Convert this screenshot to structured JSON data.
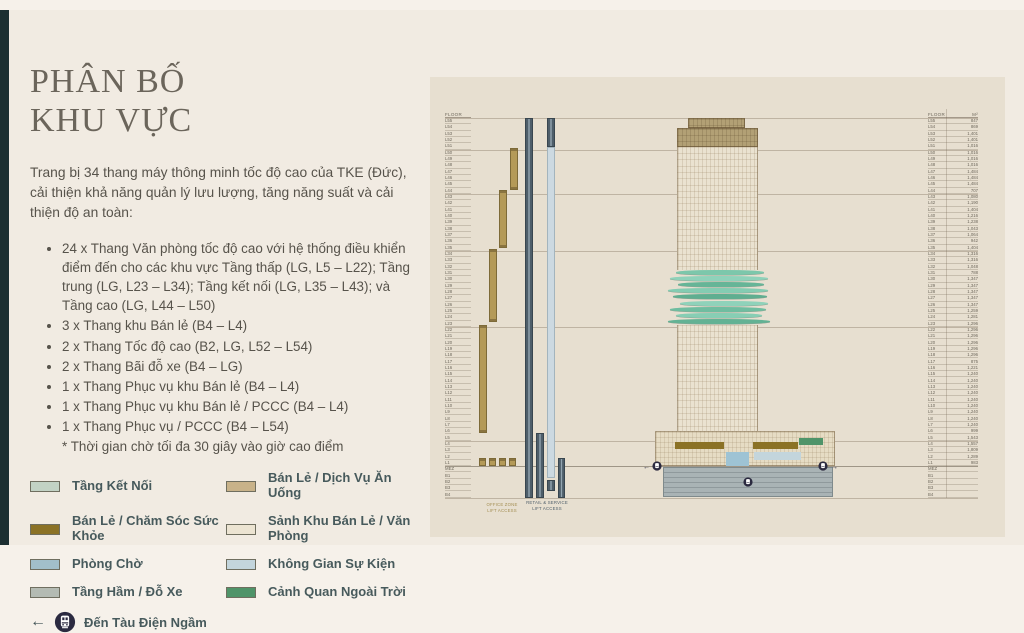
{
  "header": {
    "title_line1": "PHÂN BỐ",
    "title_line2": "KHU VỰC",
    "intro": "Trang bị 34 thang máy thông minh tốc độ cao của TKE (Đức), cải thiện khả năng quản lý lưu lượng, tăng năng suất và cải thiện độ an toàn:",
    "bullets": [
      "24 x Thang Văn phòng tốc độ cao với hệ thống điều khiển điểm đến cho các khu vực Tầng thấp (LG, L5 – L22); Tầng trung (LG, L23 – L34); Tầng kết nối (LG, L35 – L43); và Tầng cao (LG, L44 – L50)",
      "3 x Thang khu Bán lẻ (B4 – L4)",
      "2 x Thang Tốc độ cao (B2, LG, L52 – L54)",
      "2 x Thang Bãi đỗ xe (B4 – LG)",
      "1 x Thang Phục vụ khu Bán lẻ (B4 – L4)",
      "1 x Thang Phục vụ khu Bán lẻ / PCCC (B4 – L4)",
      "1 x Thang Phục vụ / PCCC (B4 – L54)"
    ],
    "footnote": "* Thời gian chờ tối đa 30 giây vào giờ cao điểm"
  },
  "legend": {
    "left": [
      {
        "label": "Tầng Kết Nối",
        "color": "#c2d2c4"
      },
      {
        "label": "Bán Lẻ / Chăm Sóc Sức Khỏe",
        "color": "#8b7226"
      },
      {
        "label": "Phòng Chờ",
        "color": "#a2bfca"
      },
      {
        "label": "Tầng Hầm / Đỗ Xe",
        "color": "#b4bbb3"
      }
    ],
    "right": [
      {
        "label": "Bán Lẻ / Dịch Vụ Ăn Uống",
        "color": "#c8b289"
      },
      {
        "label": "Sảnh Khu Bán Lẻ / Văn Phòng",
        "color": "#ece4d2"
      },
      {
        "label": "Không Gian Sự Kiện",
        "color": "#c3d5dc"
      },
      {
        "label": "Cảnh Quan Ngoài Trời",
        "color": "#4f9469"
      }
    ],
    "metro_arrow": "←",
    "metro_label": "Đến Tàu Điện Ngầm"
  },
  "diagram": {
    "left_header": "FLOOR",
    "right_header_floor": "FLOOR",
    "right_header_area": "M²",
    "shaft_labels": [
      {
        "line1": "OFFICE ZONE",
        "line2": "LIFT ACCESS"
      },
      {
        "line1": "RETAIL & SERVICE",
        "line2": "LIFT ACCESS"
      }
    ],
    "boundaries_below": [
      "L51",
      "L44",
      "L35",
      "L23",
      "L5",
      "B4"
    ],
    "ground_below": "L1",
    "floors": [
      {
        "name": "L55",
        "area": "847"
      },
      {
        "name": "L54",
        "area": "869"
      },
      {
        "name": "L53",
        "area": "1,401"
      },
      {
        "name": "L52",
        "area": "1,401"
      },
      {
        "name": "L51",
        "area": "1,016"
      },
      {
        "name": "L50",
        "area": "1,016"
      },
      {
        "name": "L49",
        "area": "1,016"
      },
      {
        "name": "L48",
        "area": "1,016"
      },
      {
        "name": "L47",
        "area": "1,484"
      },
      {
        "name": "L46",
        "area": "1,484"
      },
      {
        "name": "L45",
        "area": "1,484"
      },
      {
        "name": "L44",
        "area": "707"
      },
      {
        "name": "L43",
        "area": "1,080"
      },
      {
        "name": "L42",
        "area": "1,190"
      },
      {
        "name": "L41",
        "area": "1,404"
      },
      {
        "name": "L40",
        "area": "1,216"
      },
      {
        "name": "L39",
        "area": "1,238"
      },
      {
        "name": "L38",
        "area": "1,043"
      },
      {
        "name": "L37",
        "area": "1,064"
      },
      {
        "name": "L36",
        "area": "942"
      },
      {
        "name": "L35",
        "area": "1,404"
      },
      {
        "name": "L34",
        "area": "1,316"
      },
      {
        "name": "L33",
        "area": "1,316"
      },
      {
        "name": "L32",
        "area": "1,048"
      },
      {
        "name": "L31",
        "area": "788"
      },
      {
        "name": "L30",
        "area": "1,347"
      },
      {
        "name": "L29",
        "area": "1,347"
      },
      {
        "name": "L28",
        "area": "1,347"
      },
      {
        "name": "L27",
        "area": "1,347"
      },
      {
        "name": "L26",
        "area": "1,347"
      },
      {
        "name": "L25",
        "area": "1,259"
      },
      {
        "name": "L24",
        "area": "1,281"
      },
      {
        "name": "L23",
        "area": "1,296"
      },
      {
        "name": "L22",
        "area": "1,296"
      },
      {
        "name": "L21",
        "area": "1,296"
      },
      {
        "name": "L20",
        "area": "1,296"
      },
      {
        "name": "L19",
        "area": "1,296"
      },
      {
        "name": "L18",
        "area": "1,296"
      },
      {
        "name": "L17",
        "area": "875"
      },
      {
        "name": "L16",
        "area": "1,221"
      },
      {
        "name": "L15",
        "area": "1,240"
      },
      {
        "name": "L14",
        "area": "1,240"
      },
      {
        "name": "L13",
        "area": "1,240"
      },
      {
        "name": "L12",
        "area": "1,240"
      },
      {
        "name": "L11",
        "area": "1,240"
      },
      {
        "name": "L10",
        "area": "1,240"
      },
      {
        "name": "L9",
        "area": "1,240"
      },
      {
        "name": "L8",
        "area": "1,240"
      },
      {
        "name": "L7",
        "area": "1,240"
      },
      {
        "name": "L6",
        "area": "999"
      },
      {
        "name": "L5",
        "area": "1,543"
      },
      {
        "name": "L4",
        "area": "1,557"
      },
      {
        "name": "L3",
        "area": "1,809"
      },
      {
        "name": "L2",
        "area": "1,289"
      },
      {
        "name": "L1",
        "area": "983"
      },
      {
        "name": "MEZ",
        "area": ""
      },
      {
        "name": "B1",
        "area": ""
      },
      {
        "name": "B2",
        "area": ""
      },
      {
        "name": "B3",
        "area": ""
      },
      {
        "name": "B4",
        "area": ""
      }
    ],
    "terrace_stripes": [
      {
        "l": 8,
        "w": 88,
        "c": "#7cc7ab"
      },
      {
        "l": 2,
        "w": 98,
        "c": "#8fd2ba"
      },
      {
        "l": 10,
        "w": 86,
        "c": "#66b597"
      },
      {
        "l": 0,
        "w": 100,
        "c": "#84ccb2"
      },
      {
        "l": 5,
        "w": 94,
        "c": "#5fae90"
      },
      {
        "l": 12,
        "w": 88,
        "c": "#8fd2ba"
      },
      {
        "l": 2,
        "w": 96,
        "c": "#6fbda0"
      },
      {
        "l": 8,
        "w": 86,
        "c": "#87ceb4"
      },
      {
        "l": 0,
        "w": 102,
        "c": "#63b294"
      }
    ],
    "colors": {
      "accent_strip": "#1c2f31",
      "page_bg": "#f1ebe2",
      "panel_bg": "#e7dfd0",
      "office_shaft_tan": "#b49a58",
      "service_shaft_slate": "#4e5e6a",
      "shuttle_shaft_blue": "#ccd9e1",
      "tower_tan": "#b2a075",
      "terrace_green": "#76c3a8",
      "basement_gray": "#a9b3b5",
      "metro_navy": "#2b2a40"
    }
  }
}
